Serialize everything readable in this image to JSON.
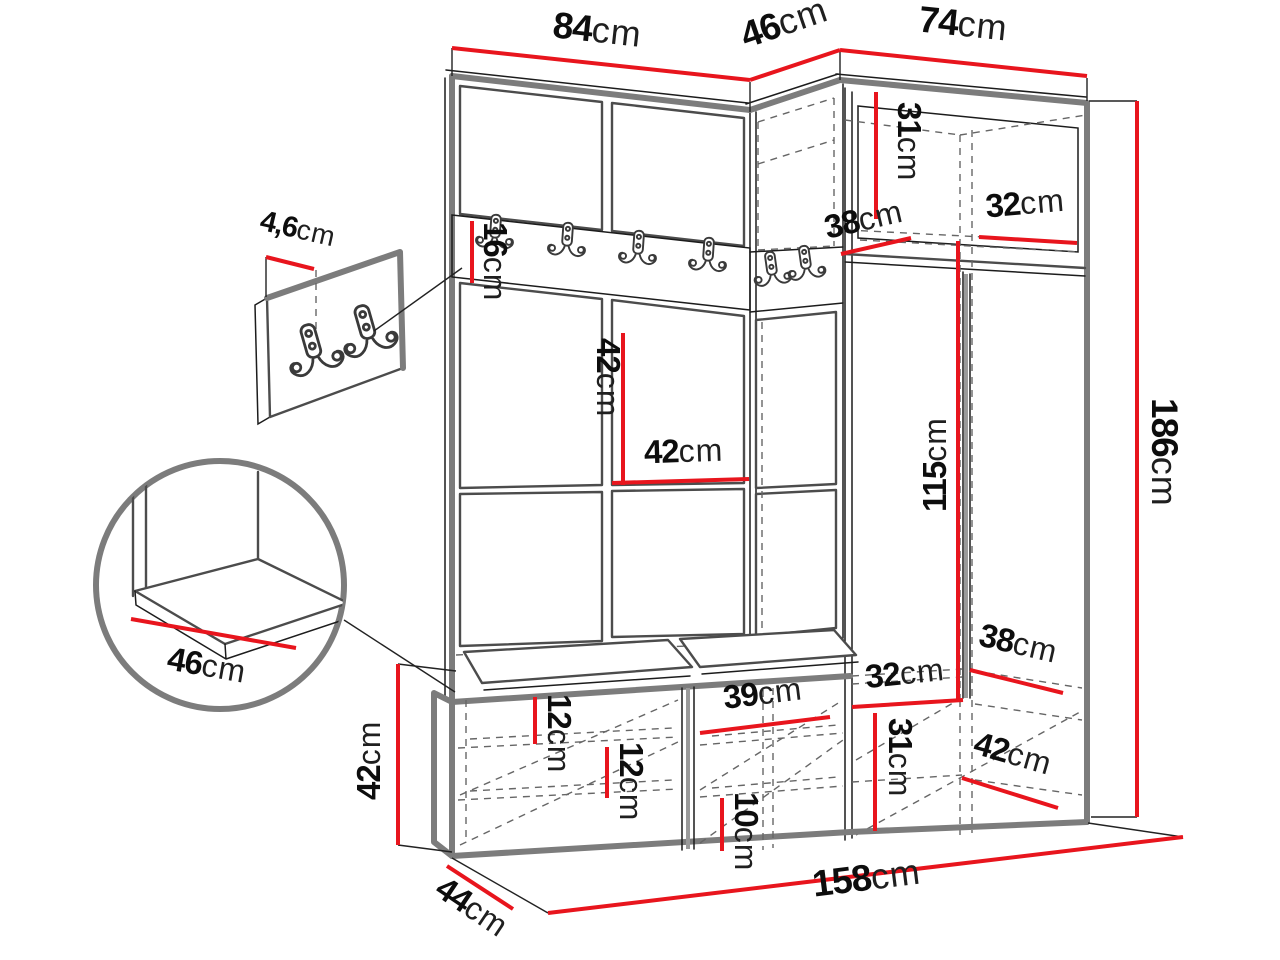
{
  "colors": {
    "dimension": "#e8151d",
    "outline": "#7c7c7c",
    "line": "#1c1c1c",
    "hidden": "#666666",
    "background": "#ffffff"
  },
  "diagram_type": "furniture-dimension-drawing",
  "dimensions": {
    "top_width_left": {
      "value": "84",
      "unit": "cm"
    },
    "top_corner_depth": {
      "value": "46",
      "unit": "cm"
    },
    "top_width_right": {
      "value": "74",
      "unit": "cm"
    },
    "hook_panel_thickness": {
      "value": "4,6",
      "unit": "cm"
    },
    "hook_rail_height": {
      "value": "16",
      "unit": "cm"
    },
    "upper_cabinet_inner_height": {
      "value": "31",
      "unit": "cm"
    },
    "corner_shelf_width": {
      "value": "38",
      "unit": "cm"
    },
    "upper_shelf_depth": {
      "value": "32",
      "unit": "cm"
    },
    "panel_height": {
      "value": "42",
      "unit": "cm"
    },
    "panel_width": {
      "value": "42",
      "unit": "cm"
    },
    "hanging_space_height": {
      "value": "115",
      "unit": "cm"
    },
    "total_height": {
      "value": "186",
      "unit": "cm"
    },
    "seat_depth_detail": {
      "value": "46",
      "unit": "cm"
    },
    "bench_height": {
      "value": "42",
      "unit": "cm"
    },
    "shelf_gap_upper": {
      "value": "12",
      "unit": "cm"
    },
    "shelf_gap_lower": {
      "value": "12",
      "unit": "cm"
    },
    "compartment_width": {
      "value": "39",
      "unit": "cm"
    },
    "bottom_gap": {
      "value": "10",
      "unit": "cm"
    },
    "lower_shelf_depth": {
      "value": "32",
      "unit": "cm"
    },
    "lower_shelf_height": {
      "value": "31",
      "unit": "cm"
    },
    "lower_shelf_width": {
      "value": "38",
      "unit": "cm"
    },
    "lower_compartment_depth": {
      "value": "42",
      "unit": "cm"
    },
    "total_width": {
      "value": "158",
      "unit": "cm"
    },
    "bench_depth": {
      "value": "44",
      "unit": "cm"
    }
  }
}
